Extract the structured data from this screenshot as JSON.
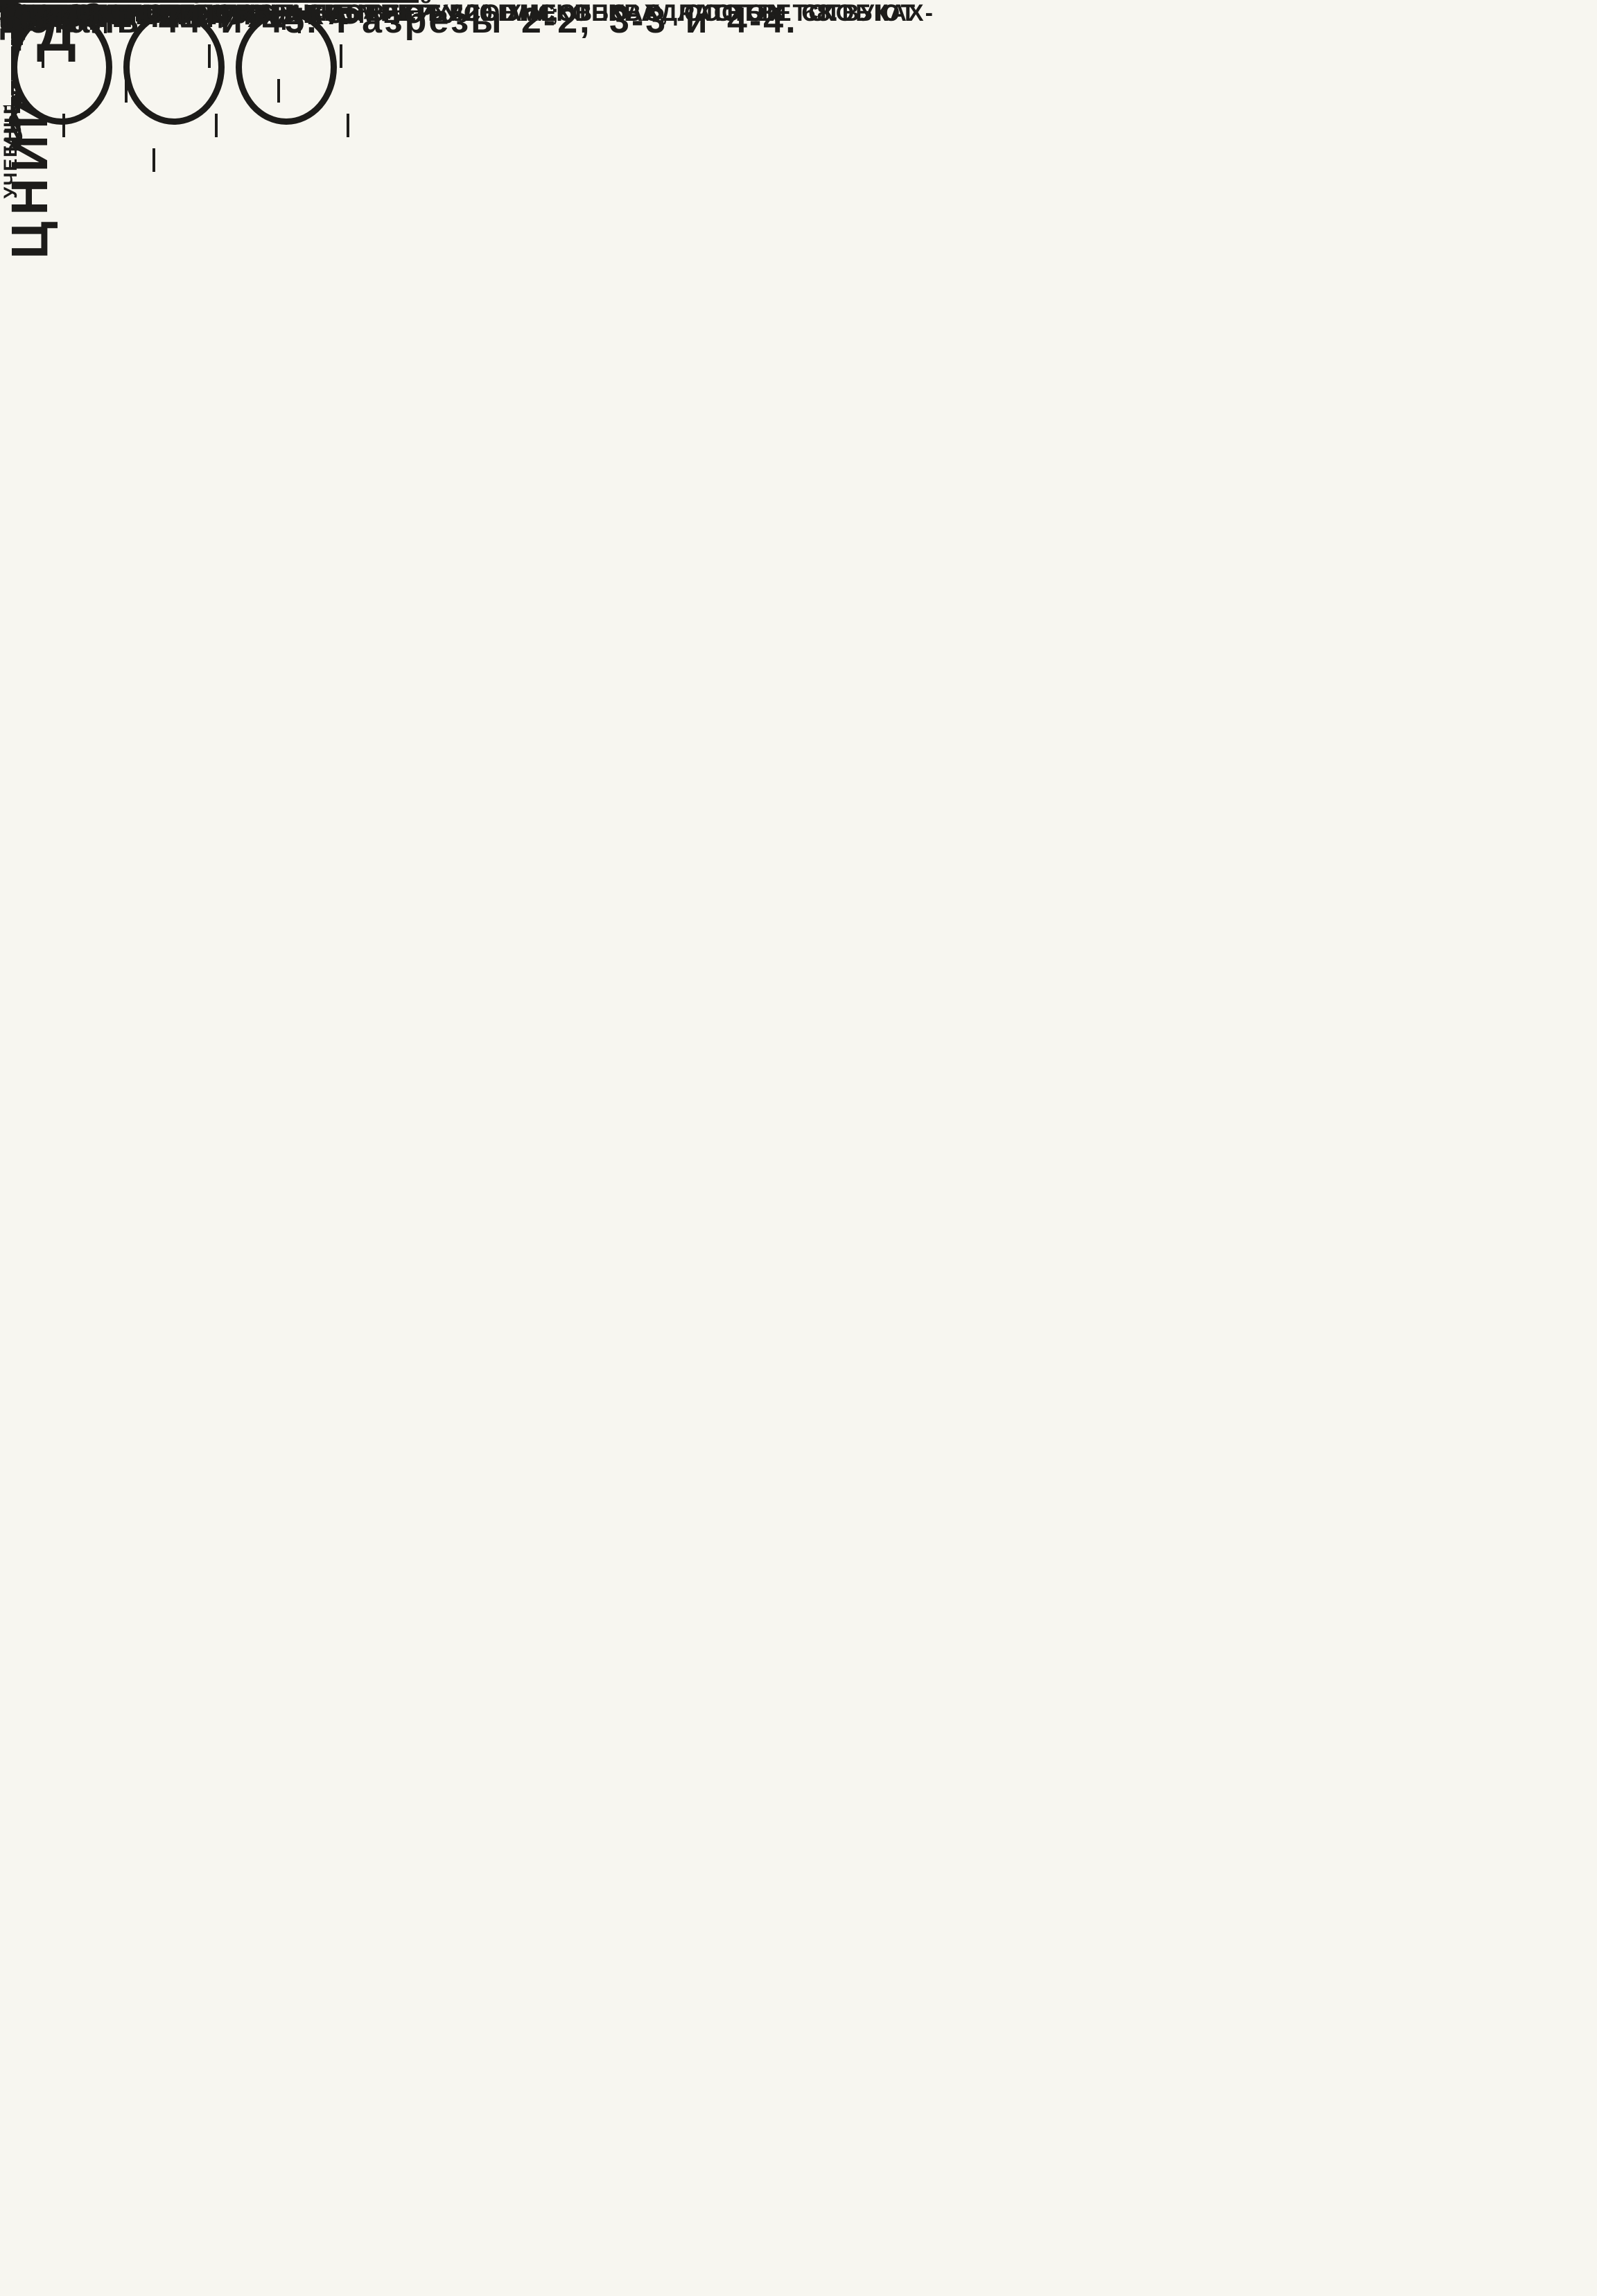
{
  "page": {
    "corner_sheet_no": "83",
    "footer_doc_no": "10248",
    "footer_sheet_no": "83"
  },
  "sidebar": {
    "invent_label": "ИНВЕНТ. №",
    "vzamen_label": "ВЗАМЕН",
    "rows": [
      {
        "title": "НАЧ. ОТДЕЛА",
        "name": ""
      },
      {
        "title": "ГЛ. ИНЖ. ПР-ТА",
        "name": "КЛЕБАНОВ"
      },
      {
        "title": "РУК. ГРУППЫ",
        "name": "БАЛАКШИНА"
      },
      {
        "title": "СТ. ИНЖ.",
        "name": "ТЕРЕНИНА"
      }
    ],
    "institute": "ЦНИИЭП",
    "institute_sub": "УЧЕБНЫХ  ЗДАНИЙ"
  },
  "fig_top": {
    "masonry_l1": "КАМЕННАЯ",
    "masonry_l2": "КЛАДКА"
  },
  "sec22": {
    "title": "2-2",
    "callout1": "ЗАБЕТОНИРОВАТЬ ПО МЕСТУ",
    "callout2": "БЕТОНОМ  М 200",
    "dim_height": "260",
    "mark": "ММ 9л",
    "dim_gap": "50",
    "masonry_l1": "КАМЕННАЯ",
    "masonry_l2": "КЛАДКА",
    "dim1": "460",
    "dim2": "(540)",
    "dim3": "[620]"
  },
  "sec33": {
    "title": "3-3",
    "callout1": "ЗАДЕЛАТЬ",
    "callout2": "РАСТВОРОМ ДЛЯ",
    "callout3": "КЛАДКИ",
    "masonry": "КАМЕННАЯ КЛАДКА",
    "dim1": "460",
    "dim2": "(540)",
    "dim3": "[620]"
  },
  "sec44": {
    "title": "4-4"
  },
  "notes": {
    "heading": "ПРИМЕЧАНИЯ:",
    "line1": "1.  НАСТОЯЩИЙ  ЛИСТ  СМОТРЕТЬ  СОВМЕСТНО   С ЛИСТОМ 68.",
    "line2": "2.  РАЗМЕРЫ,  УКАЗАННЫЕ  В  КРУГЛЫХ  СКОБКАХ,  СООТВЕТСТВУЮТ",
    "line3": "ТОЛЩИНЕ  СТЕНОВЫХ  ПАНЕЛЕЙ  320 ММ;  В  КВАДРАТНЫХ  СКОБКАХ-",
    "line4": "ТОЛЩИНЕ  СТЕНОВЫХ  ПАНЕЛЕЙ  400 ММ."
  },
  "titleblock": {
    "code": "ТД",
    "year": "1969г.",
    "title": "Деталь 44 и 45. Разрезы  2-2, 3-3  и  4-4.",
    "series_label": "СЕРИЯ",
    "series": "2.240-1",
    "issue_label": "ВЫПУСК",
    "issue": "I",
    "sheet_label": "ЛИСТ",
    "sheet": "69"
  }
}
